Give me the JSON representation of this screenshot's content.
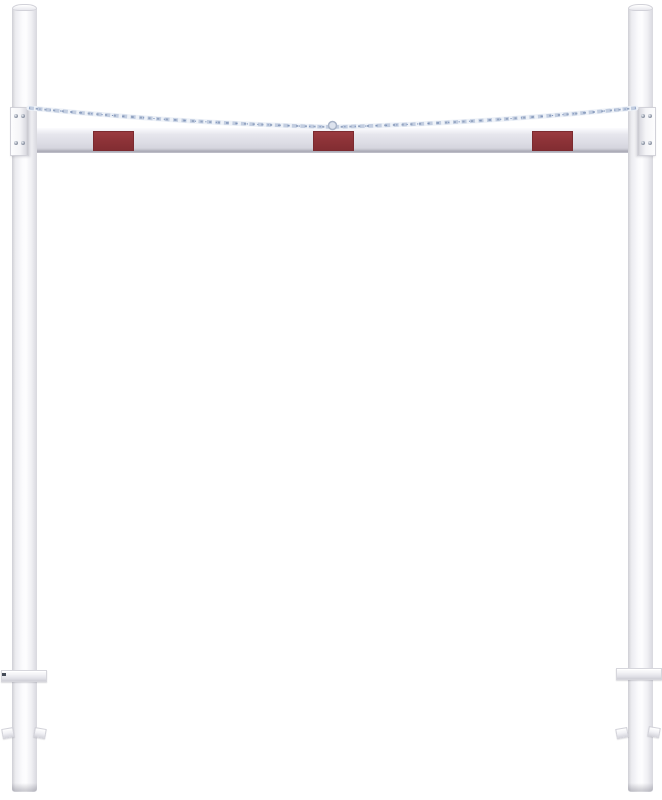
{
  "meta": {
    "description": "Product render of a white height-restriction barrier: two round upright posts, a horizontal crossbar with three red reflective panels, two suspension chains running from post-top brackets down to the centre of the crossbar, bolted mounting brackets, ground-level plates and concrete-in anchor lugs on the buried post ends.",
    "visible_text": "",
    "background": "#ffffff"
  },
  "parts": {
    "left_post": "Left upright post",
    "right_post": "Right upright post",
    "crossbar": "Horizontal height-limit crossbar",
    "reflector_left": "Red reflective panel (left)",
    "reflector_center": "Red reflective panel (centre)",
    "reflector_right": "Red reflective panel (right)",
    "chain_left": "Suspension chain from left post to crossbar centre",
    "chain_right": "Suspension chain from right post to crossbar centre",
    "chain_connector": "Chain connector ring at crossbar centre",
    "bracket_left": "Bolted mounting bracket on left post",
    "bracket_right": "Bolted mounting bracket on right post",
    "ground_plate_left": "Ground-level plate on left post",
    "ground_plate_right": "Ground-level plate on right post",
    "anchor_left": "Ground anchor lugs on left post",
    "anchor_right": "Ground anchor lugs on right post"
  },
  "colors": {
    "background": "#ffffff",
    "post_light": "#fbfbfd",
    "post_mid": "#efeff3",
    "post_edge": "#cfcfd5",
    "bar_face": "#dddde5",
    "bar_top": "#fcfcfe",
    "bar_bottom": "#a9a9b4",
    "reflector_red": "#8e3338",
    "reflector_border": "#7c2a2f",
    "chain_light": "#eef2f8",
    "chain_mid": "#c2cde0",
    "chain_dark": "#92a3c0",
    "chain_blue": "#6e87b5",
    "bolt": "#8b93a3",
    "metal_shadow": "#c6c6cd"
  }
}
